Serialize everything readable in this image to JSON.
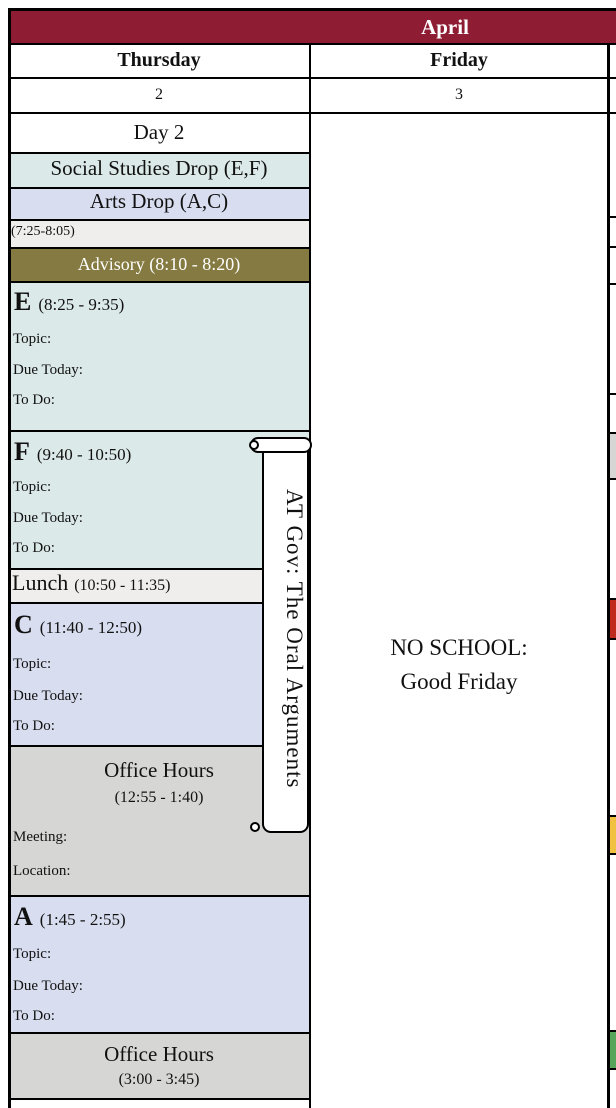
{
  "colors": {
    "header_maroon": "#8e1c33",
    "block_teal": "#dbe9e8",
    "block_lavender": "#d8def0",
    "row_light_gray": "#efeeec",
    "advisory_olive": "#857a41",
    "office_hours_gray": "#d6d6d4",
    "adjacent_event_red": "#c02b1e",
    "adjacent_event_yellow": "#f0c23f",
    "adjacent_event_green": "#57a55a",
    "grid_border": "#000000"
  },
  "month_bar": {
    "label": "April"
  },
  "day_headers": [
    {
      "name": "Thursday",
      "date": "2"
    },
    {
      "name": "Friday",
      "date": "3"
    }
  ],
  "thursday": {
    "day_label": "Day 2",
    "drop_rows": [
      {
        "label": "Social Studies Drop (E,F)"
      },
      {
        "label": "Arts Drop (A,C)"
      }
    ],
    "early_slot": "(7:25-8:05)",
    "advisory": "Advisory (8:10 - 8:20)",
    "blocks": [
      {
        "letter": "E",
        "time": "(8:25 - 9:35)",
        "topic_label": "Topic:",
        "due_label": "Due Today:",
        "todo_label": "To Do:"
      },
      {
        "letter": "F",
        "time": "(9:40 - 10:50)",
        "topic_label": "Topic:",
        "due_label": "Due Today:",
        "todo_label": "To Do:"
      },
      {
        "letter": "C",
        "time": "(11:40 - 12:50)",
        "topic_label": "Topic:",
        "due_label": "Due Today:",
        "todo_label": "To Do:"
      },
      {
        "letter": "A",
        "time": "(1:45 - 2:55)",
        "topic_label": "Topic:",
        "due_label": "Due Today:",
        "todo_label": "To Do:"
      }
    ],
    "lunch": {
      "label": "Lunch",
      "time": "(10:50 - 11:35)"
    },
    "office_hours": [
      {
        "title": "Office Hours",
        "time": "(12:55 - 1:40)",
        "meeting_label": "Meeting:",
        "location_label": "Location:"
      },
      {
        "title": "Office Hours",
        "time": "(3:00 - 3:45)"
      }
    ]
  },
  "friday": {
    "note_line1": "NO SCHOOL:",
    "note_line2": "Good Friday"
  },
  "banner": {
    "text": "AT Gov: The Oral Arguments"
  }
}
